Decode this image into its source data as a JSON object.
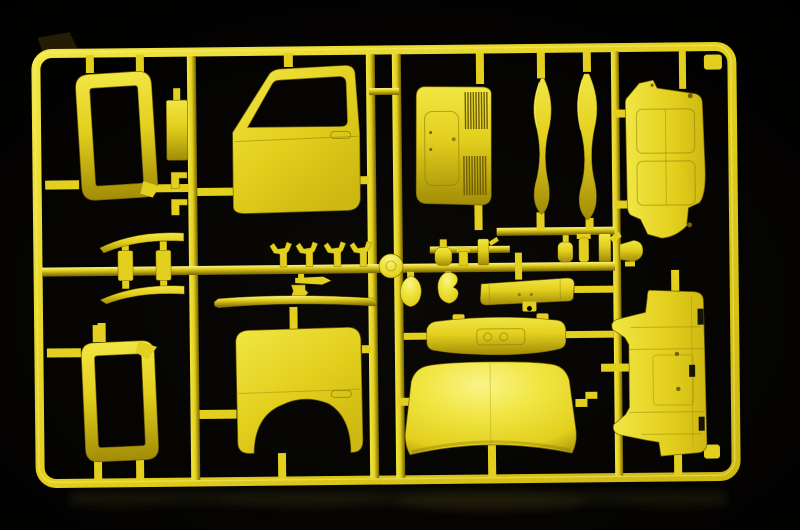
{
  "scene": {
    "description": "Photograph of a yellow injection-molded plastic model-kit sprue (parts tree for a truck cab) lying on a black surface with a faint floor reflection"
  },
  "colors": {
    "c-bg": "#000000",
    "c-bg-soft": "#0a0906",
    "c-base": "#e3cf1d",
    "c-bright": "#f1e644",
    "c-highlight": "#f9f489",
    "c-mid": "#cdb911",
    "c-shadow": "#a18c07",
    "c-deep": "#746303",
    "c-line": "#8d7a05",
    "c-vent": "#6f5f03",
    "c-tabdark": "#241d04",
    "c-refl": "#35300f"
  },
  "parts": [
    {
      "id": "sprue-frame",
      "label": "rectangular sprue frame runner"
    },
    {
      "id": "window-frame-upper",
      "label": "upper cab window frame part"
    },
    {
      "id": "mounting-plate",
      "label": "small rectangular plate part"
    },
    {
      "id": "clip-brackets",
      "label": "two small clip bracket parts"
    },
    {
      "id": "front-door-panel",
      "label": "front door panel with window opening"
    },
    {
      "id": "cab-rear-panel",
      "label": "cab rear panel with vent grilles"
    },
    {
      "id": "trim-blade-left",
      "label": "left curved trim blade part"
    },
    {
      "id": "trim-blade-right",
      "label": "right curved trim blade part"
    },
    {
      "id": "engine-cover-panel",
      "label": "engine cover panel with recessed lines"
    },
    {
      "id": "visor-strip-assembly",
      "label": "curved visor strips with link blocks"
    },
    {
      "id": "handle-parts-set",
      "label": "four small handle and mirror arm parts"
    },
    {
      "id": "lever-part",
      "label": "small lever blade with holder"
    },
    {
      "id": "drip-rail-strip",
      "label": "long thin drip rail strip"
    },
    {
      "id": "hub-disc",
      "label": "round disc part"
    },
    {
      "id": "small-fittings-group",
      "label": "small bottle and cylinder fittings"
    },
    {
      "id": "mirror-shell",
      "label": "teardrop mirror shell part"
    },
    {
      "id": "hook-shell",
      "label": "curved hook shell part"
    },
    {
      "id": "bumper-bar",
      "label": "bumper bar with center bracket"
    },
    {
      "id": "dashboard-panel",
      "label": "curved dashboard panel"
    },
    {
      "id": "roof-panel",
      "label": "domed cab roof panel"
    },
    {
      "id": "rear-door-panel",
      "label": "rear door panel with wheel arch cutout"
    },
    {
      "id": "window-frame-lower",
      "label": "lower cab window frame part"
    },
    {
      "id": "floor-panel",
      "label": "cab floor panel with slots"
    },
    {
      "id": "pot-fitting",
      "label": "small pot shaped fitting"
    },
    {
      "id": "runner-network",
      "label": "internal runner bars and connection stubs"
    },
    {
      "id": "floor-reflection",
      "label": "faint reflection on the black surface"
    }
  ]
}
